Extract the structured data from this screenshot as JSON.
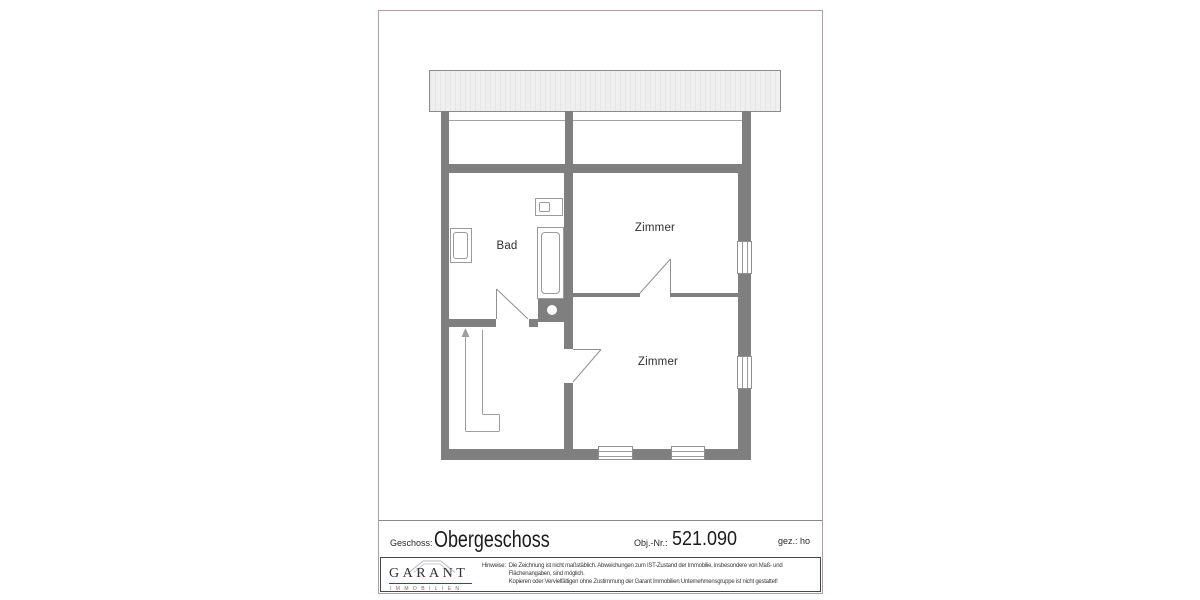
{
  "plan": {
    "room_labels": [
      {
        "name": "bad",
        "label": "Bad"
      },
      {
        "name": "zimmer-upper",
        "label": "Zimmer"
      },
      {
        "name": "zimmer-lower",
        "label": "Zimmer"
      }
    ]
  },
  "title_block": {
    "geschoss_label": "Geschoss:",
    "geschoss_value": "Obergeschoss",
    "obj_label": "Obj.-Nr.:",
    "obj_value": "521.090",
    "gez_label": "gez.: ho"
  },
  "footer": {
    "logo_text": "GARANT",
    "logo_subtext": "IMMOBILIEN",
    "disclaimer_label": "Hinweise:",
    "disclaimer_lines": [
      "Die Zeichnung ist nicht maßstäblich. Abweichungen zum IST-Zustand der Immobilie, insbesondere von Maß- und",
      "Flächenangaben, sind möglich.",
      "Kopieren oder Vervielfältigen ohne Zustimmung der Garant Immobilien Unternehmensgruppe ist nicht gestattet!"
    ]
  },
  "colors": {
    "wall": "#7f7f7f",
    "frame_border": "#b89aa2",
    "footer_border": "#474747",
    "logo_line": "#7b2f3a",
    "roof_band_fill": "#efefef"
  }
}
